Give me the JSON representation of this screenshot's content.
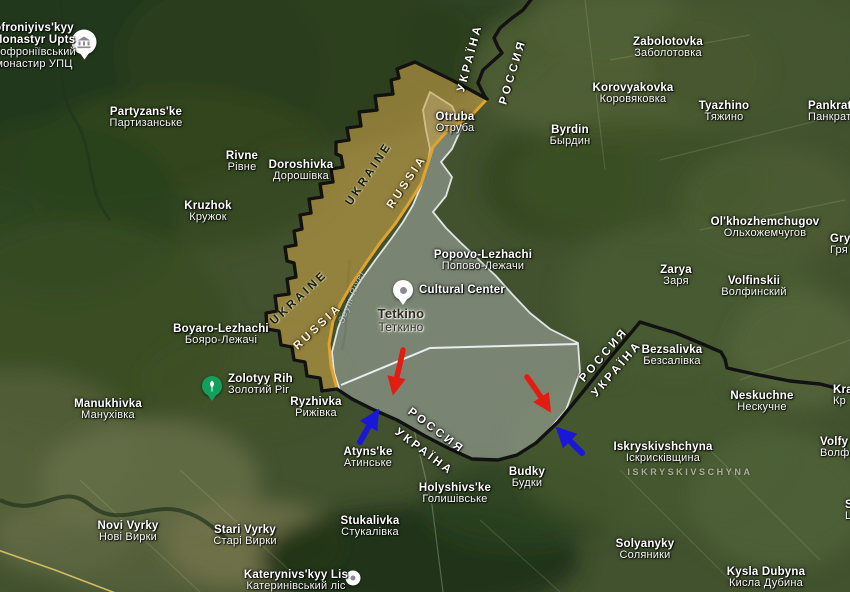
{
  "map": {
    "description_visible_area": "Satellite map of the Ukraine-Russia border near Tetkino / Popovo-Lezhachi with highlighted advance zone, gray contested zone, state border line and red/blue direction arrows"
  },
  "colors": {
    "advance_zone": "#c9a24a",
    "advance_zone_border": "#e0a32e",
    "gray_zone": "#ccd2d6",
    "gray_zone_border": "#eef2f4",
    "state_border": "#121212",
    "attack_arrow": "#e31c12",
    "counter_arrow": "#1a18d8",
    "park_pin": "#12a05c",
    "road_yellow": "#cfbd62"
  },
  "region_labels": [
    {
      "id": "sofroniyivskyy-monastyr",
      "x": 34,
      "y": 22,
      "lines": [
        {
          "t": "ofroniyivs'kyy",
          "c": "en"
        },
        {
          "t": "Monastyr Upts",
          "c": "en"
        },
        {
          "t": "Софроніївський",
          "c": "uk"
        },
        {
          "t": "монастир УПЦ",
          "c": "uk"
        }
      ]
    },
    {
      "id": "partyzanske",
      "x": 146,
      "y": 106,
      "lines": [
        {
          "t": "Partyzans'ke",
          "c": "en"
        },
        {
          "t": "Партизанське",
          "c": "uk"
        }
      ]
    },
    {
      "id": "rivne",
      "x": 242,
      "y": 150,
      "lines": [
        {
          "t": "Rivne",
          "c": "en"
        },
        {
          "t": "Рівне",
          "c": "uk"
        }
      ]
    },
    {
      "id": "doroshivka",
      "x": 301,
      "y": 159,
      "lines": [
        {
          "t": "Doroshivka",
          "c": "en"
        },
        {
          "t": "Дорошівка",
          "c": "uk"
        }
      ]
    },
    {
      "id": "kruzhok",
      "x": 208,
      "y": 200,
      "lines": [
        {
          "t": "Kruzhok",
          "c": "en"
        },
        {
          "t": "Кружок",
          "c": "uk"
        }
      ]
    },
    {
      "id": "otruba",
      "x": 455,
      "y": 111,
      "lines": [
        {
          "t": "Otruba",
          "c": "en"
        },
        {
          "t": "Отруба",
          "c": "uk"
        }
      ]
    },
    {
      "id": "zabolotovka",
      "x": 668,
      "y": 36,
      "lines": [
        {
          "t": "Zabolotovka",
          "c": "en"
        },
        {
          "t": "Заболотовка",
          "c": "uk"
        }
      ]
    },
    {
      "id": "korovyakovka",
      "x": 633,
      "y": 82,
      "lines": [
        {
          "t": "Korovyakovka",
          "c": "en"
        },
        {
          "t": "Коровяковка",
          "c": "uk"
        }
      ]
    },
    {
      "id": "tyazhino",
      "x": 724,
      "y": 100,
      "lines": [
        {
          "t": "Tyazhino",
          "c": "en"
        },
        {
          "t": "Тяжино",
          "c": "uk"
        }
      ]
    },
    {
      "id": "pankratovka-cut",
      "x": 808,
      "y": 100,
      "align": "left",
      "lines": [
        {
          "t": "Pankrato",
          "c": "en"
        },
        {
          "t": "Панкрат",
          "c": "uk"
        }
      ]
    },
    {
      "id": "byrdin",
      "x": 570,
      "y": 124,
      "lines": [
        {
          "t": "Byrdin",
          "c": "en"
        },
        {
          "t": "Бырдин",
          "c": "uk"
        }
      ]
    },
    {
      "id": "popovo-lezhachi",
      "x": 483,
      "y": 249,
      "lines": [
        {
          "t": "Popovo-Lezhachi",
          "c": "en"
        },
        {
          "t": "Попово-Лежачи",
          "c": "uk"
        }
      ]
    },
    {
      "id": "cultural-center",
      "x": 462,
      "y": 284,
      "lines": [
        {
          "t": "Cultural Center",
          "c": "en"
        }
      ]
    },
    {
      "id": "tetkino",
      "x": 401,
      "y": 307,
      "variant": "town-dark",
      "lines": [
        {
          "t": "Tetkino",
          "c": "en"
        },
        {
          "t": "Теткино",
          "c": "uk"
        }
      ]
    },
    {
      "id": "olkhozhemchugov",
      "x": 765,
      "y": 216,
      "lines": [
        {
          "t": "Ol'khozhemchugov",
          "c": "en"
        },
        {
          "t": "Ольхожемчугов",
          "c": "uk"
        }
      ]
    },
    {
      "id": "zarya",
      "x": 676,
      "y": 264,
      "lines": [
        {
          "t": "Zarya",
          "c": "en"
        },
        {
          "t": "Заря",
          "c": "uk"
        }
      ]
    },
    {
      "id": "volfinskii",
      "x": 754,
      "y": 275,
      "lines": [
        {
          "t": "Volfinskii",
          "c": "en"
        },
        {
          "t": "Волфинский",
          "c": "uk"
        }
      ]
    },
    {
      "id": "gryaznoe-cut",
      "x": 830,
      "y": 233,
      "align": "left",
      "lines": [
        {
          "t": "Gry",
          "c": "en"
        },
        {
          "t": "Гря",
          "c": "uk"
        }
      ]
    },
    {
      "id": "boyaro-lezhachi",
      "x": 221,
      "y": 323,
      "lines": [
        {
          "t": "Boyaro-Lezhachi",
          "c": "en"
        },
        {
          "t": "Бояро-Лежачі",
          "c": "uk"
        }
      ]
    },
    {
      "id": "bezsalivka",
      "x": 672,
      "y": 344,
      "lines": [
        {
          "t": "Bezsalivka",
          "c": "en"
        },
        {
          "t": "Безсалівка",
          "c": "uk"
        }
      ]
    },
    {
      "id": "neskuchne",
      "x": 762,
      "y": 390,
      "lines": [
        {
          "t": "Neskuchne",
          "c": "en"
        },
        {
          "t": "Нескучне",
          "c": "uk"
        }
      ]
    },
    {
      "id": "zolotyy-rih",
      "x": 228,
      "y": 373,
      "align": "left",
      "lines": [
        {
          "t": "Zolotyy Rih",
          "c": "en"
        },
        {
          "t": "Золотий Ріг",
          "c": "uk"
        }
      ]
    },
    {
      "id": "manukhivka",
      "x": 108,
      "y": 398,
      "lines": [
        {
          "t": "Manukhivka",
          "c": "en"
        },
        {
          "t": "Манухівка",
          "c": "uk"
        }
      ]
    },
    {
      "id": "ryzhivka",
      "x": 316,
      "y": 396,
      "lines": [
        {
          "t": "Ryzhivka",
          "c": "en"
        },
        {
          "t": "Рижівка",
          "c": "uk"
        }
      ]
    },
    {
      "id": "kra-cut",
      "x": 833,
      "y": 384,
      "align": "left",
      "lines": [
        {
          "t": "Kra",
          "c": "en"
        },
        {
          "t": "Кр",
          "c": "uk"
        }
      ]
    },
    {
      "id": "volfino-cut",
      "x": 820,
      "y": 436,
      "align": "left",
      "lines": [
        {
          "t": "Volfy",
          "c": "en"
        },
        {
          "t": "Волф",
          "c": "uk"
        }
      ]
    },
    {
      "id": "iskryskivshchyna",
      "x": 663,
      "y": 441,
      "lines": [
        {
          "t": "Iskryskivshchyna",
          "c": "en"
        },
        {
          "t": "Іскрисківщина",
          "c": "uk"
        }
      ]
    },
    {
      "id": "iskryskivshchyna-district",
      "x": 690,
      "y": 468,
      "variant": "faint-caps",
      "lines": [
        {
          "t": "ISKRYSKIVSCHYNA",
          "c": "en"
        }
      ]
    },
    {
      "id": "atynske",
      "x": 368,
      "y": 446,
      "lines": [
        {
          "t": "Atyns'ke",
          "c": "en"
        },
        {
          "t": "Атинське",
          "c": "uk"
        }
      ]
    },
    {
      "id": "budky",
      "x": 527,
      "y": 466,
      "lines": [
        {
          "t": "Budky",
          "c": "en"
        },
        {
          "t": "Будки",
          "c": "uk"
        }
      ]
    },
    {
      "id": "holyshivske",
      "x": 455,
      "y": 482,
      "lines": [
        {
          "t": "Holyshivs'ke",
          "c": "en"
        },
        {
          "t": "Голишівське",
          "c": "uk"
        }
      ]
    },
    {
      "id": "stukalivka",
      "x": 370,
      "y": 515,
      "lines": [
        {
          "t": "Stukalivka",
          "c": "en"
        },
        {
          "t": "Стукалівка",
          "c": "uk"
        }
      ]
    },
    {
      "id": "novi-vyrky",
      "x": 128,
      "y": 520,
      "lines": [
        {
          "t": "Novi Vyrky",
          "c": "en"
        },
        {
          "t": "Нові Вирки",
          "c": "uk"
        }
      ]
    },
    {
      "id": "stari-vyrky",
      "x": 245,
      "y": 524,
      "lines": [
        {
          "t": "Stari Vyrky",
          "c": "en"
        },
        {
          "t": "Старі Вирки",
          "c": "uk"
        }
      ]
    },
    {
      "id": "solyanyky",
      "x": 645,
      "y": 538,
      "lines": [
        {
          "t": "Solyanyky",
          "c": "en"
        },
        {
          "t": "Соляники",
          "c": "uk"
        }
      ]
    },
    {
      "id": "kysla-dubyna",
      "x": 766,
      "y": 566,
      "lines": [
        {
          "t": "Kysla Dubyna",
          "c": "en"
        },
        {
          "t": "Кисла Дубина",
          "c": "uk"
        }
      ]
    },
    {
      "id": "katerynivskyy-lis",
      "x": 296,
      "y": 569,
      "lines": [
        {
          "t": "Katerynivs'kyy Lis",
          "c": "en"
        },
        {
          "t": "Катеринівський ліс",
          "c": "uk"
        }
      ]
    },
    {
      "id": "edge-fragment",
      "x": 845,
      "y": 499,
      "align": "left",
      "lines": [
        {
          "t": "S",
          "c": "en"
        },
        {
          "t": "L",
          "c": "uk"
        }
      ]
    },
    {
      "id": "seym-river",
      "x": 352,
      "y": 292,
      "rot": -68,
      "variant": "river",
      "lines": [
        {
          "t": "Seym River",
          "c": "en"
        }
      ]
    }
  ],
  "border_labels": [
    {
      "id": "ukraina-north",
      "text": "УКРАЇНА",
      "x": 470,
      "y": 58,
      "rot": -75,
      "variant": "light"
    },
    {
      "id": "rossiya-north",
      "text": "РОССИЯ",
      "x": 513,
      "y": 72,
      "rot": -73,
      "variant": "light"
    },
    {
      "id": "ukraine-upper",
      "text": "UKRAINE",
      "x": 369,
      "y": 174,
      "rot": -56,
      "variant": "dark"
    },
    {
      "id": "russia-upper",
      "text": "RUSSIA",
      "x": 407,
      "y": 182,
      "rot": -56,
      "variant": "cream"
    },
    {
      "id": "ukraine-lower",
      "text": "UKRAINE",
      "x": 299,
      "y": 298,
      "rot": -43,
      "variant": "dark"
    },
    {
      "id": "russia-lower",
      "text": "RUSSIA",
      "x": 318,
      "y": 327,
      "rot": -43,
      "variant": "cream"
    },
    {
      "id": "rossiya-center",
      "text": "РОССИЯ",
      "x": 436,
      "y": 431,
      "rot": 37,
      "variant": "light"
    },
    {
      "id": "ukraina-center",
      "text": "УКРАЇНА",
      "x": 424,
      "y": 452,
      "rot": 37,
      "variant": "light"
    },
    {
      "id": "rossiya-east",
      "text": "РОССИЯ",
      "x": 604,
      "y": 355,
      "rot": -49,
      "variant": "light"
    },
    {
      "id": "ukraina-east",
      "text": "УКРАЇНА",
      "x": 617,
      "y": 369,
      "rot": -49,
      "variant": "light"
    }
  ],
  "pois": [
    {
      "id": "monastery-pin",
      "icon": "monastery-icon",
      "x": 84,
      "y": 42
    },
    {
      "id": "cultural-center-pin",
      "icon": "cultural-center-icon",
      "x": 403,
      "y": 290
    },
    {
      "id": "zolotyy-rih-pin",
      "icon": "park-tree-icon",
      "x": 212,
      "y": 386
    },
    {
      "id": "katerynivskyy-lis-pin",
      "icon": "place-dot-icon",
      "x": 353,
      "y": 578
    }
  ],
  "annotations": {
    "attack_arrows_count": 2,
    "counter_arrows_count": 2
  }
}
